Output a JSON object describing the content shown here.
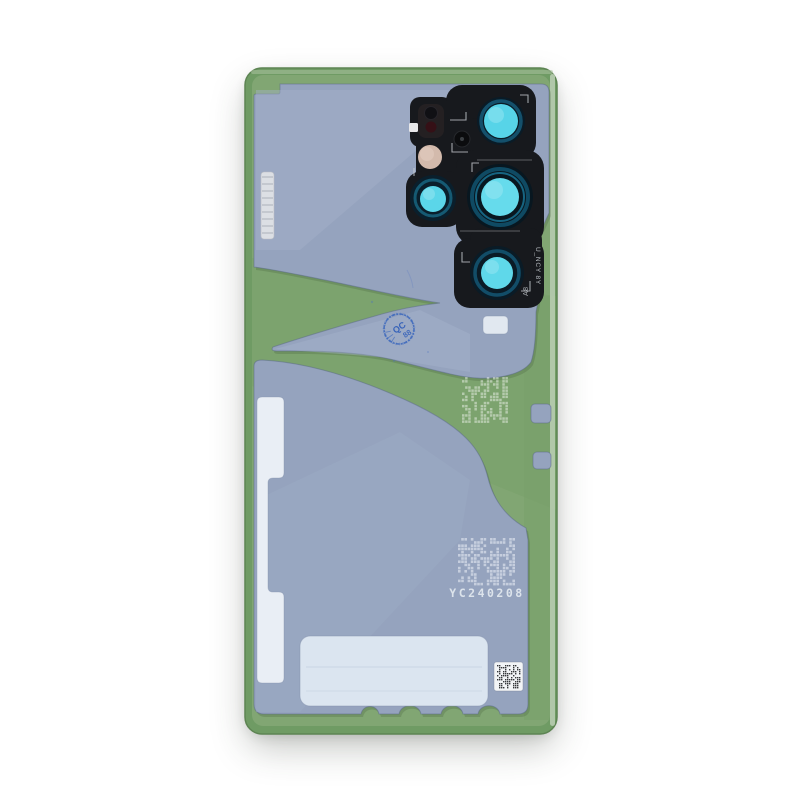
{
  "product": {
    "name": "phone-back-cover-with-adhesive",
    "serial_code": "YC240208",
    "camera_frame_code_primary": "U_NCY 8Y",
    "camera_frame_code_secondary": "A8",
    "qc_stamp_text": "QC",
    "qc_stamp_number": "88"
  },
  "palette": {
    "background": "#ffffff",
    "glass_edge_green": "#6f9b64",
    "adhesive_green": "#81a673",
    "band_green": "#78a069",
    "liner_blue": "#95a3be",
    "liner_sheen": "#a5b2c9",
    "module_black": "#17191d",
    "lens_ring_blue": "#0d3750",
    "lens_ring_teal": "#1a789a",
    "lens_cyan": "#60d8ea",
    "flash_maroon": "#351016",
    "sensor_cream": "#d3baac",
    "stamp_blue": "#2e5cb8",
    "white_parts": "#e9eef5",
    "code_white": "#e6ecf2",
    "qr_dark": "#202226"
  },
  "decor": {
    "matrices": [
      {
        "x": 462,
        "y": 377,
        "cols": 15,
        "rows": 15,
        "cell": 3.1,
        "fill": "#eef4ec",
        "opacity": 0.5,
        "seed": 7,
        "density": 0.5
      },
      {
        "x": 458,
        "y": 538,
        "cols": 18,
        "rows": 15,
        "cell": 3.2,
        "fill": "#eef2f7",
        "opacity": 0.55,
        "seed": 13,
        "density": 0.5
      },
      {
        "x": 497,
        "y": 665,
        "cols": 12,
        "rows": 12,
        "cell": 2.0,
        "fill": "#202226",
        "opacity": 0.9,
        "seed": 3,
        "density": 0.55
      }
    ],
    "tab_stripes": {
      "x": 262,
      "y": 177,
      "w": 11,
      "count": 9,
      "gap": 7,
      "stroke": "#b4b9c1"
    }
  }
}
